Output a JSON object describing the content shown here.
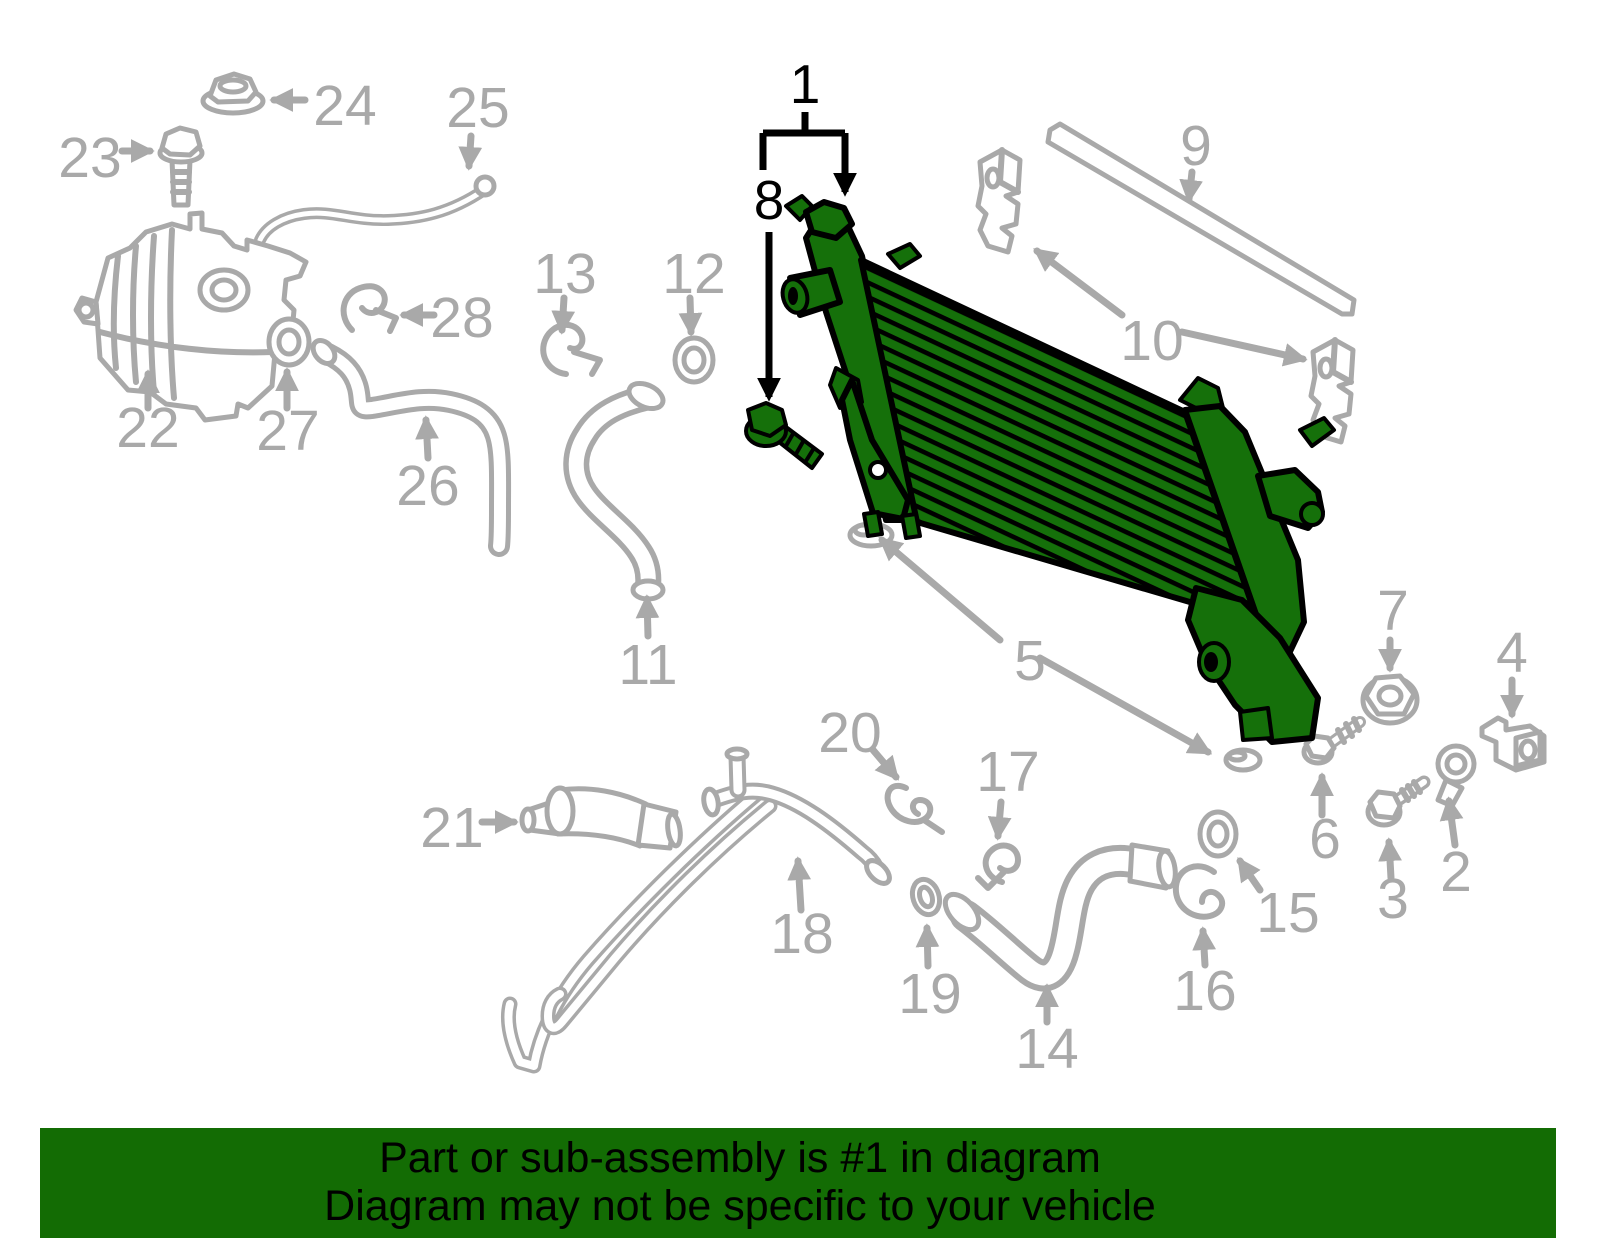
{
  "diagram": {
    "highlighted_part_number": "1",
    "labels": {
      "1": "1",
      "2": "2",
      "3": "3",
      "4": "4",
      "5": "5",
      "6": "6",
      "7": "7",
      "8": "8",
      "9": "9",
      "10": "10",
      "11": "11",
      "12": "12",
      "13": "13",
      "14": "14",
      "15": "15",
      "16": "16",
      "17": "17",
      "18": "18",
      "19": "19",
      "20": "20",
      "21": "21",
      "22": "22",
      "23": "23",
      "24": "24",
      "25": "25",
      "26": "26",
      "27": "27",
      "28": "28"
    },
    "colors": {
      "highlight_green": "#15700a",
      "line_art_gray": "#a9a9a9",
      "callout_black": "#000000"
    }
  },
  "banner": {
    "line1": "Part or sub-assembly is #1 in diagram",
    "line2": "Diagram may not be specific to your vehicle",
    "bg": "#136c04",
    "text_color": "#000000"
  }
}
